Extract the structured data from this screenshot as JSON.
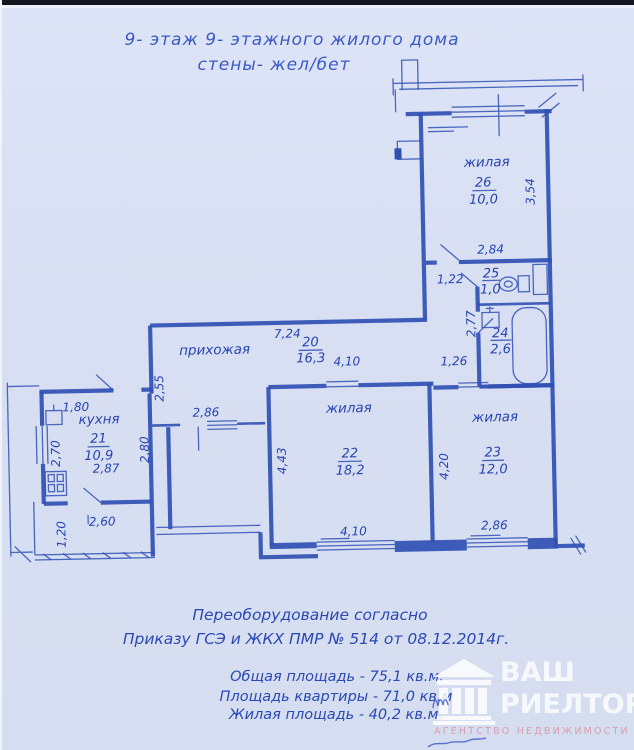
{
  "header": {
    "line1": "9- этаж  9- этажного жилого дома",
    "line2": "стены- жел/бет"
  },
  "plan": {
    "rooms": {
      "r26": {
        "name": "жилая",
        "number": "26",
        "area": "10,0"
      },
      "r25": {
        "number": "25",
        "area": "1,0"
      },
      "r24": {
        "number": "24",
        "area": "2,6"
      },
      "r20": {
        "name": "прихожая",
        "number": "20",
        "area": "16,3"
      },
      "r21": {
        "name": "кухня",
        "number": "21",
        "area": "10,9"
      },
      "r22": {
        "name": "жилая",
        "number": "22",
        "area": "18,2"
      },
      "r23": {
        "name": "жилая",
        "number": "23",
        "area": "12,0"
      }
    },
    "dims": {
      "r26_height": "3,54",
      "r26_width": "2,84",
      "corridor_width": "1,22",
      "corridor_length": "2,77",
      "bath_entry": "1,26",
      "hall_length": "7,24",
      "hall_left": "2,55",
      "r22_width_top": "4,10",
      "r22_depth": "4,43",
      "r22_width_bottom": "4,10",
      "r23_depth": "4,20",
      "r23_width": "2,86",
      "kitchen_top": "1,80",
      "kitchen_left": "2,70",
      "kitchen_right": "2,80",
      "kitchen_bottom": "2,87",
      "hall_closet": "2,86",
      "loggia_width": "2,60",
      "loggia_depth": "1,20"
    }
  },
  "footer": {
    "note_line1": "Переоборудование согласно",
    "note_line2": "Приказу ГСЭ и ЖКХ ПМР № 514 от 08.12.2014г.",
    "total_area": "Общая площадь - 75,1 кв.м.",
    "apartment_area": "Площадь квартиры - 71,0 кв.м",
    "living_area": "Жилая площадь - 40,2 кв.м."
  },
  "logo": {
    "title_line1": "ВАШ",
    "title_line2": "РИЕЛТОР",
    "tagline": "АГЕНТСТВО НЕДВИЖИМОСТИ"
  },
  "colors": {
    "ink": "#3050b4",
    "ink-text": "#2644b0",
    "paper": "#d8dff2",
    "logo-white": "#ffffff",
    "logo-pink": "#dc93a2"
  }
}
